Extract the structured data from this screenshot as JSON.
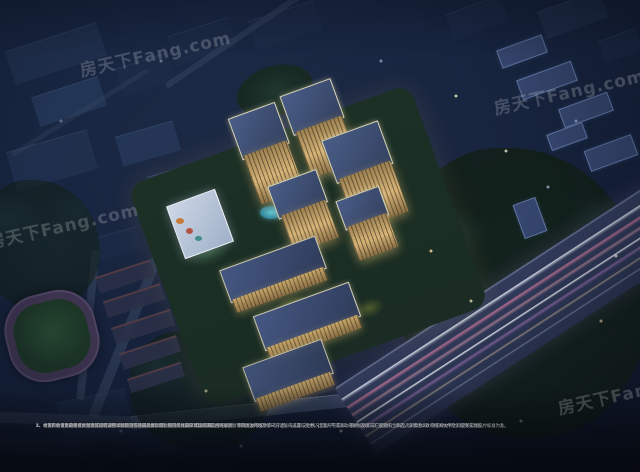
{
  "watermark": {
    "text": "房天下Fang.com"
  },
  "disclaimer": {
    "lines": [
      "1、本资料仅为要约邀请，不构成要约或承诺，买卖双方的权利义务以双方签订的《商品房买卖合同》及附件等协议为准。",
      "2、本图所示仅为建筑景观·概念设计及项目环境规划效果的大致示意，绿化、道路、配套设施、楼栋间距、景观园林等仅供参考示意，与实际交付情况可能存在差异，最终以政府部门批准的《商品房买卖合同》等法律文件之约定及实际交付标准为准。",
      "3、本资料中涉及的项目周边环境、街道、公共设施等地理位置示意，基于市政与项目的沟通和相关规划，项目周边环境及第三方设施的设置与变更，出卖人不得对政府规划及第三方设施作出承诺，详情请以政府相关文件及实际情况为准。",
      "4、本资料中使用的图例、图示等已经过技术处理，不代表最终实际比例，具体面积请以实测面积为准。",
      "5、相关内容请以最终批文为准，如有调整，恕不另行通知。本资料制作时间：2021年9月1日。"
    ]
  },
  "colors": {
    "sky_base": "#17233d",
    "tower_warm": "#d8b577",
    "roof_blue": "#3d4e74",
    "outline_glow": "#f2ebbe",
    "trail_pink": "#cd789b",
    "trail_white": "#f5f5fc",
    "field_green": "#264933",
    "track_purple": "#3d3450",
    "tree_dark": "#142419",
    "water_cyan": "#5fc3d4"
  }
}
